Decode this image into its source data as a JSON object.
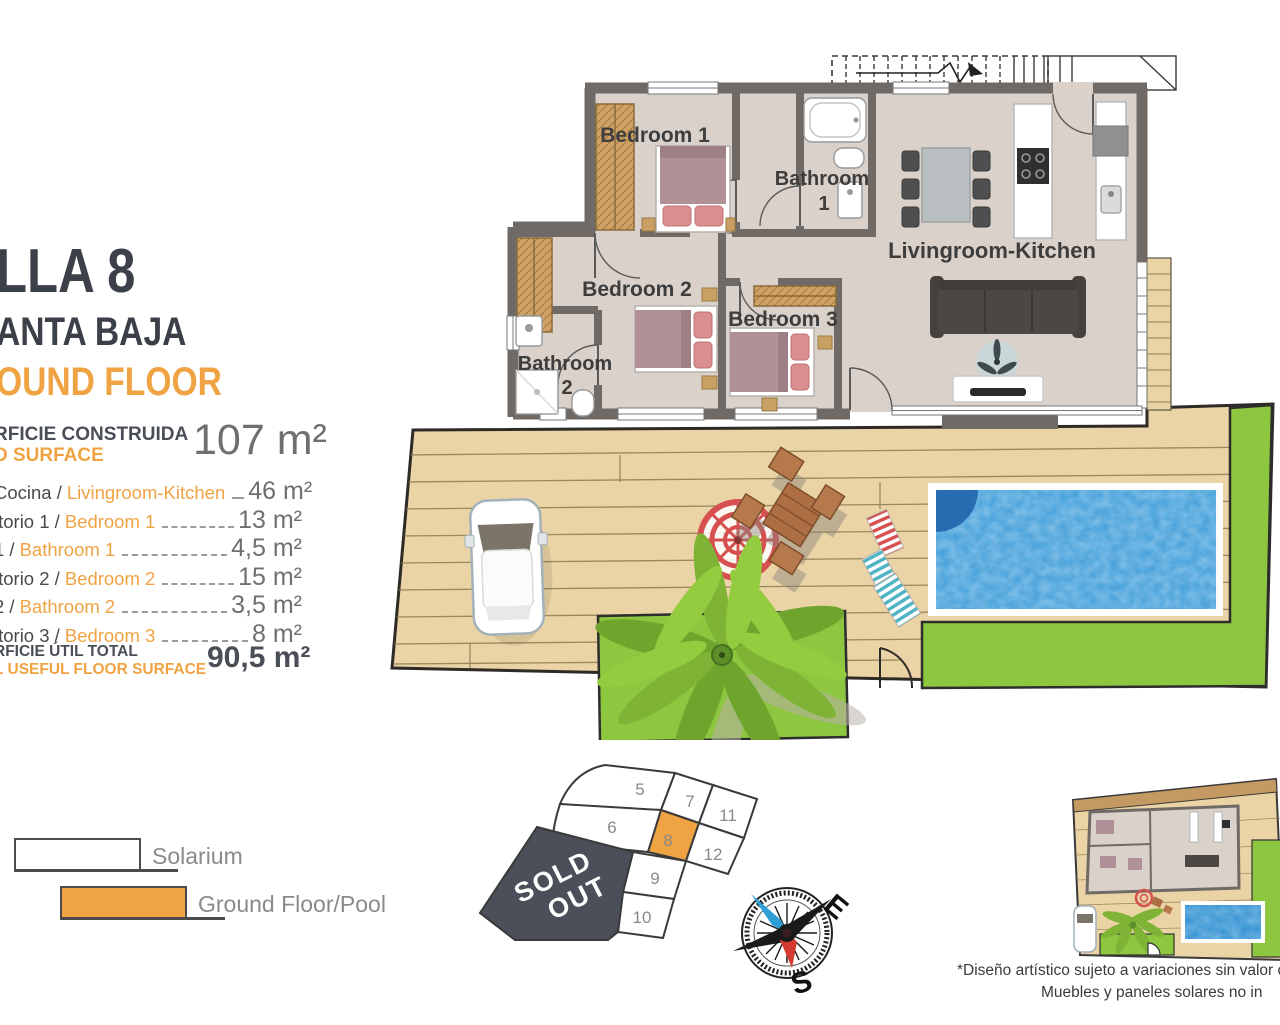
{
  "colors": {
    "accent": "#F0A343",
    "title": "#3C4049",
    "wall": "#6F6A66",
    "deck": "#EAD3A5",
    "grass": "#8DC63F",
    "pool": "#3E9CD8",
    "sold_out_bg": "#4A4F59"
  },
  "header": {
    "title": "LLA 8",
    "subtitle_es": "ANTA BAJA",
    "subtitle_en": "OUND FLOOR"
  },
  "built_surface": {
    "label_es": "RFICIE CONSTRUIDA",
    "label_en": "D SURFACE",
    "value": "107 m²"
  },
  "rooms": [
    {
      "label_es": "Cocina /",
      "label_en": "Livingroom-Kitchen",
      "value": "46 m²"
    },
    {
      "label_es": "itorio 1 /",
      "label_en": "Bedroom 1",
      "value": "13 m²"
    },
    {
      "label_es": "1 /",
      "label_en": "Bathroom 1",
      "value": "4,5 m²"
    },
    {
      "label_es": "itorio 2 /",
      "label_en": "Bedroom 2",
      "value": "15 m²"
    },
    {
      "label_es": "2 /",
      "label_en": "Bathroom 2",
      "value": "3,5 m²"
    },
    {
      "label_es": "itorio 3 /",
      "label_en": "Bedroom 3",
      "value": "8 m²"
    }
  ],
  "total": {
    "label_es": "RFICIE ÚTIL TOTAL",
    "label_en": "L USEFUL FLOOR SURFACE",
    "value": "90,5 m²"
  },
  "plan": {
    "room_labels": {
      "bedroom1": "Bedroom 1",
      "bathroom1_line1": "Bathroom",
      "bathroom1_line2": "1",
      "bedroom2": "Bedroom 2",
      "bathroom2_line1": "Bathroom",
      "bathroom2_line2": "2",
      "bedroom3": "Bedroom 3",
      "living": "Livingroom-Kitchen"
    }
  },
  "legend": {
    "items": [
      {
        "label": "Solarium",
        "swatch": "white"
      },
      {
        "label": "Ground Floor/Pool",
        "swatch": "orange"
      }
    ]
  },
  "site_map": {
    "lot_labels": [
      "5",
      "6",
      "7",
      "8",
      "9",
      "10",
      "11",
      "12"
    ],
    "highlighted_lot": "8",
    "sold_out": {
      "line1": "SOLD",
      "line2": "OUT"
    }
  },
  "compass": {
    "east": "E",
    "south": "S"
  },
  "disclaimer": {
    "line1": "*Diseño artístico sujeto a variaciones sin valor con",
    "line2": "Muebles y paneles solares no in"
  }
}
